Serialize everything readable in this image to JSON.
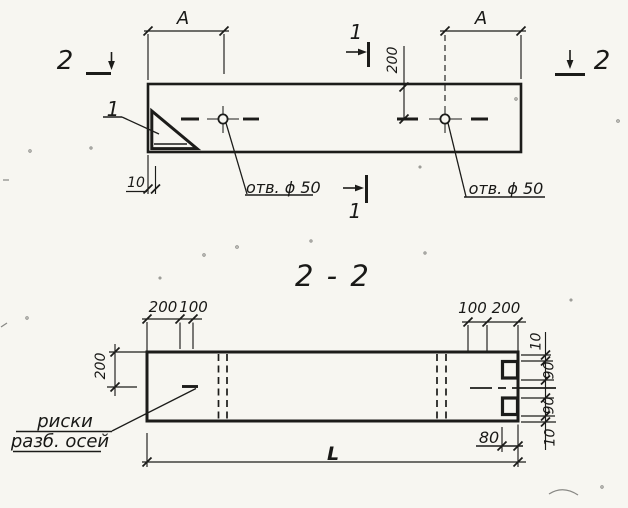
{
  "top_view": {
    "dim_a_left": "A",
    "dim_a_right": "A",
    "cut_2_left": "2",
    "cut_2_right": "2",
    "cut_1_top": "1",
    "cut_1_bottom": "1",
    "dim_200": "200",
    "dim_10": "10",
    "detail_callout": "1",
    "hole_left_label": "отв. ϕ 50",
    "hole_right_label": "отв. ϕ 50"
  },
  "section_view": {
    "title": "2 - 2",
    "top_left_dims": [
      "200",
      "100"
    ],
    "top_right_dims": [
      "100",
      "200"
    ],
    "left_dim": "200",
    "right_dims": [
      "10",
      "90",
      "90",
      "10"
    ],
    "dim_80": "80",
    "length_dim": "L",
    "axis_note_line1": "риски",
    "axis_note_line2": "разб. осей"
  }
}
